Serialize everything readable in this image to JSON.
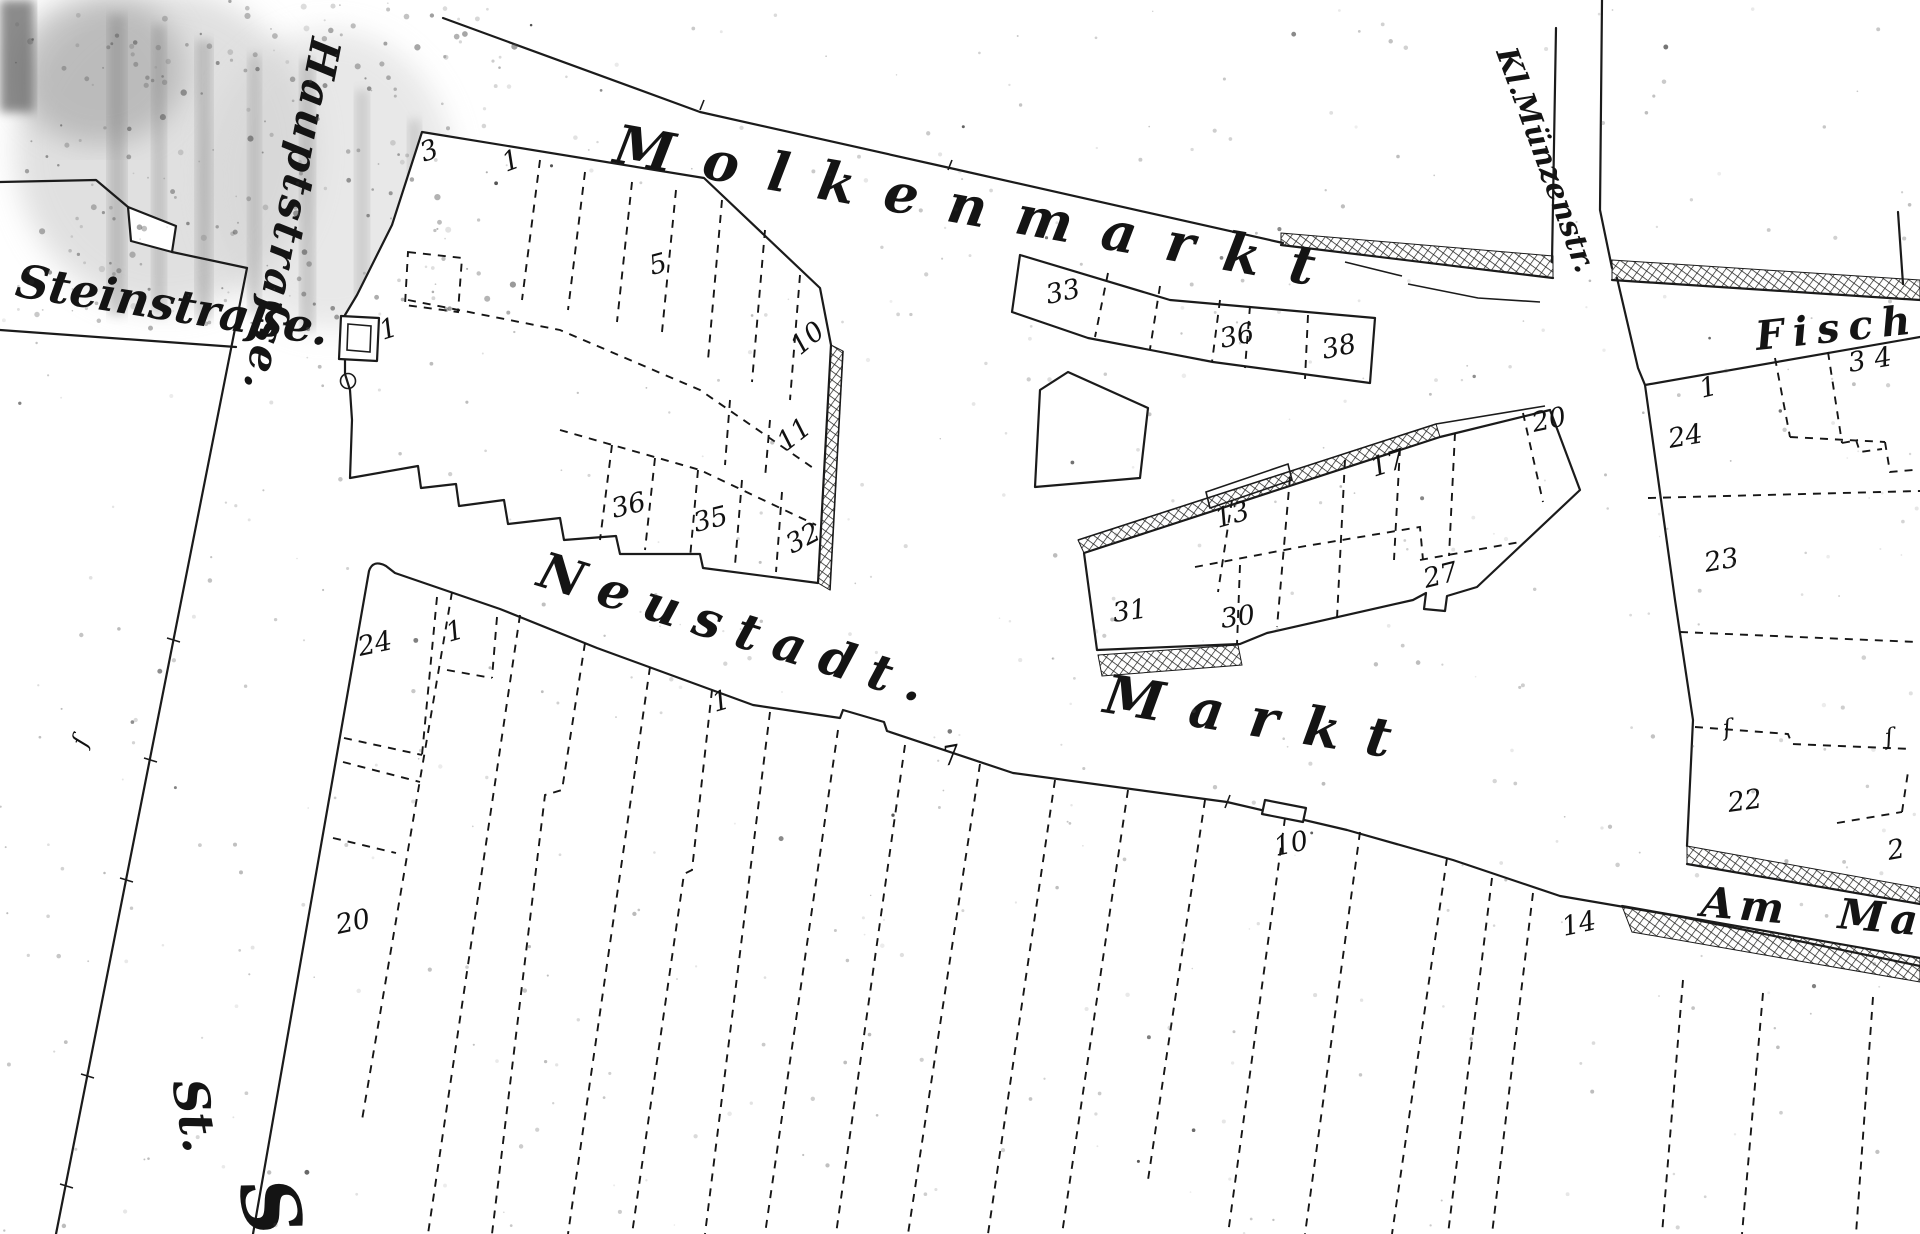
{
  "map_type": "historical-cadastral-plan",
  "colors": {
    "ink": "#1b1b1b",
    "paper": "#ffffff",
    "speckle": "#8a8a8a"
  },
  "streets": {
    "steinstrasse": "Steinstraße.",
    "hauptstrasse": "Hauptstraſse.",
    "molkenmarkt": "Molkenmarkt",
    "kl_muenzenstr": "Kl.Münzenstr.",
    "fische": "Fische",
    "neustadt": "Neustadt.",
    "markt": "Markt",
    "am_markt": "Am Ma",
    "st_abbrev": "St.",
    "st_partial": "S"
  },
  "plot_numbers": {
    "molkenmarkt_block": [
      "3",
      "1",
      "5",
      "10",
      "11",
      "36",
      "35",
      "32",
      "1"
    ],
    "market_strip": [
      "33",
      "36",
      "38"
    ],
    "central_block": [
      "13",
      "17",
      "27",
      "31",
      "30",
      "20"
    ],
    "fische_block": [
      "1",
      "24",
      "23",
      "22",
      "2",
      "3",
      "4"
    ],
    "south_area": [
      "24",
      "1",
      "20",
      "1",
      "7",
      "10",
      "14"
    ],
    "boundary_marks": [
      "ſ",
      "ſ",
      "ſ"
    ]
  }
}
